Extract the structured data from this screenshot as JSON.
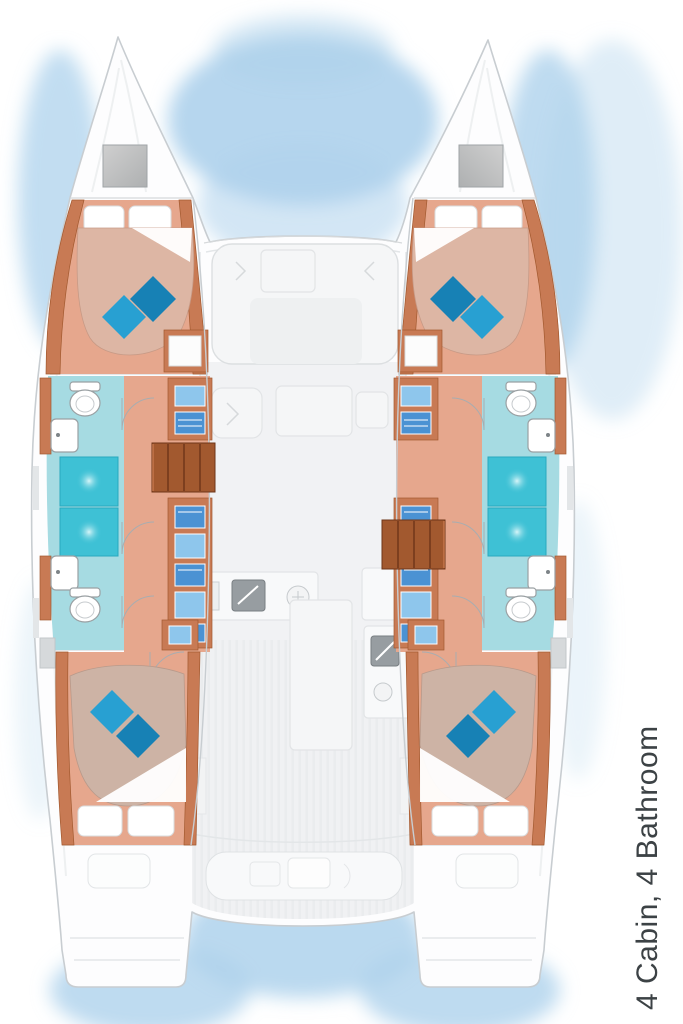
{
  "caption": {
    "label": "4 Cabin, 4 Bathroom"
  },
  "summary": {
    "cabins": 4,
    "bathrooms": 4
  },
  "plan": {
    "hulls": [
      "port",
      "starboard"
    ],
    "rooms_per_hull": [
      "forward-cabin",
      "forward-bathroom",
      "aft-bathroom",
      "aft-cabin"
    ],
    "center_areas": [
      "trampoline",
      "salon",
      "galley",
      "cockpit"
    ],
    "symbols": [
      "double-berth",
      "pillow",
      "toilet",
      "sink",
      "shower",
      "wardrobe",
      "stairs",
      "bow-hatch",
      "cockpit-bench"
    ]
  },
  "colors": {
    "hullOutline": "#c8cdd1",
    "deck": "#fdfdfe",
    "waterGlow": "#aed2ec",
    "cabinFloor": "#e6a78d",
    "woodTrim": "#c87a54",
    "woodDark": "#a2592f",
    "bedFwd": "#ddb6a4",
    "bedAft": "#cdb3a5",
    "pillowBlue": "#28a0d2",
    "pillowBlueDark": "#1781b5",
    "bathFloor": "#a6dbe2",
    "shower": "#3ec1d5",
    "wardrobeBlue": "#4b92d3",
    "wardrobeBlueLight": "#8ec6ec",
    "salonFurniture": "#f5f6f7",
    "salonOutline": "#dcdfe1",
    "galleySink": "#979da1",
    "captionText": "#3c4245"
  }
}
